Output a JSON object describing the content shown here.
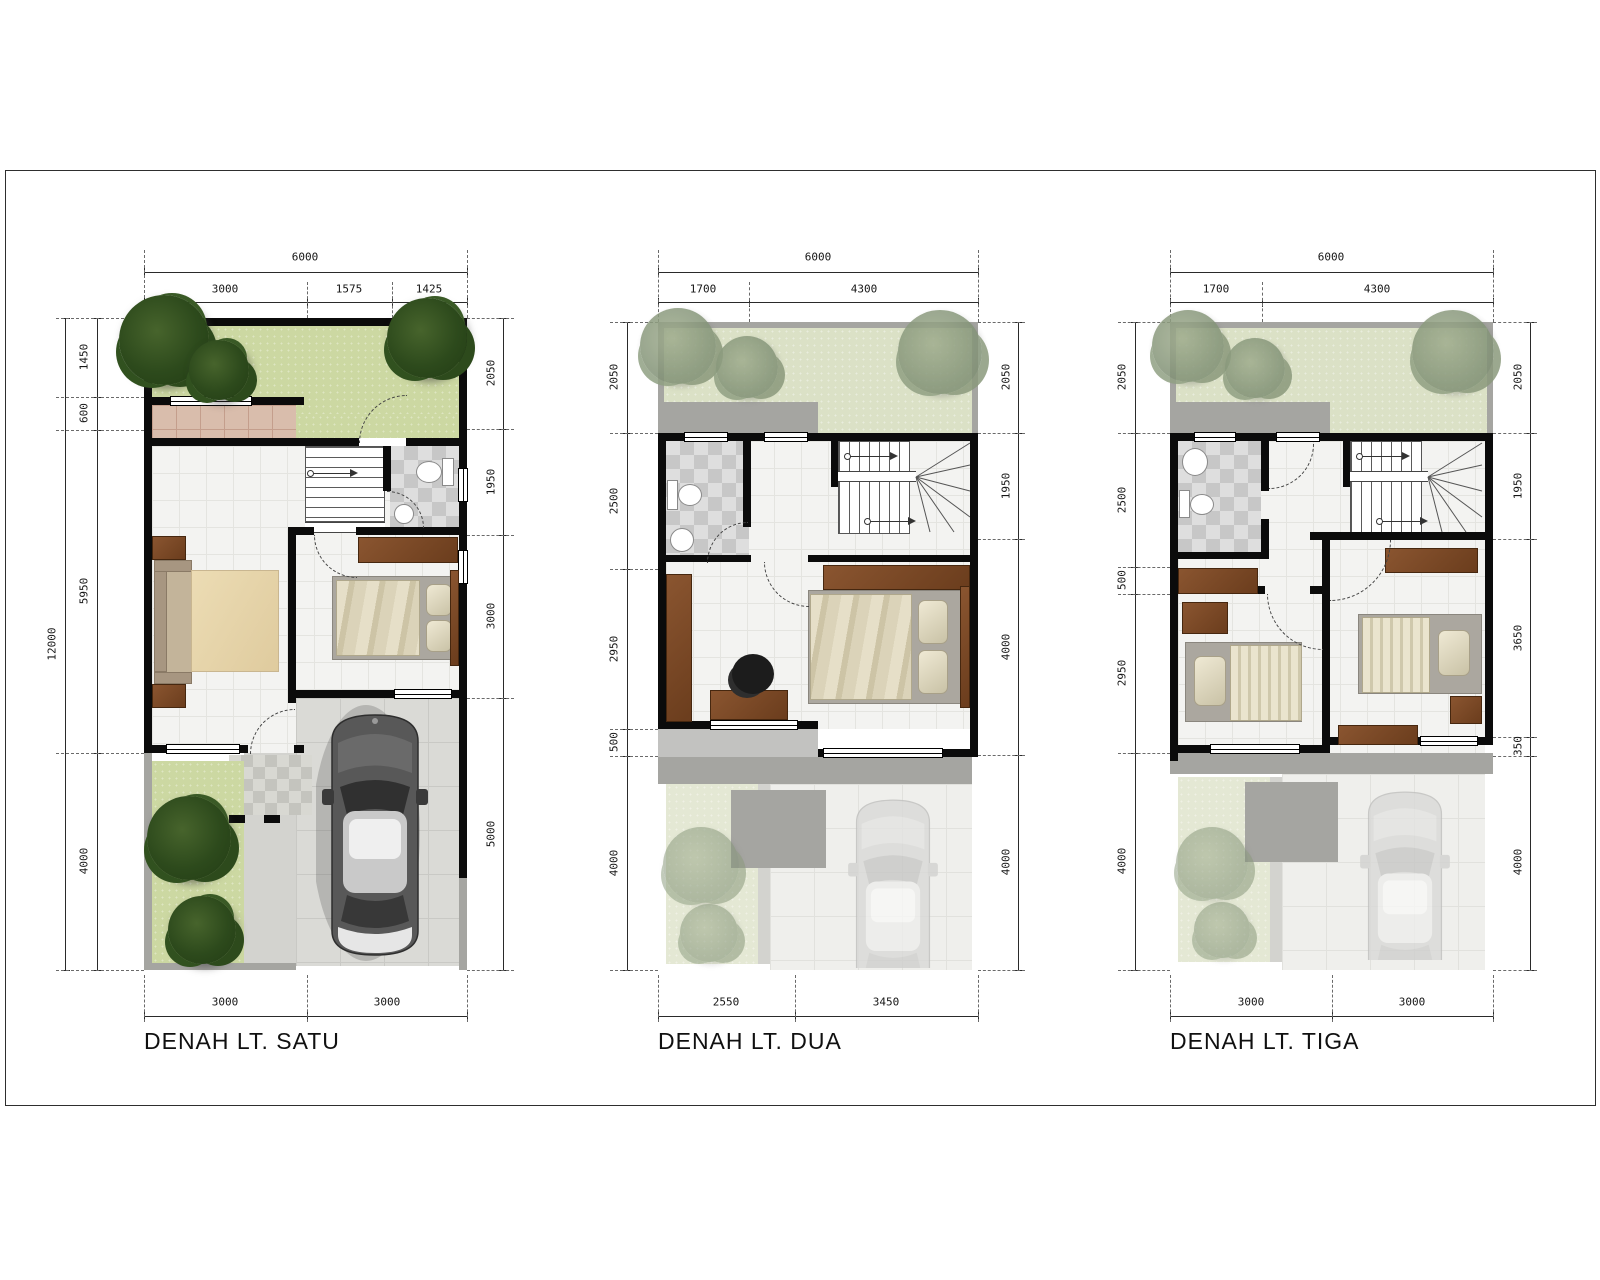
{
  "colors": {
    "wall": "#0b0b0b",
    "grass_ground_floor": "#ccd8a2",
    "grass_roof_garden": "#dbe1c6",
    "tree_dark": "#2d4a1c",
    "tree_faded": "#8a997c",
    "terrace_tile": "#d9bdac",
    "bathroom_tile": "#c7c7c7",
    "floor_tile": "#f3f3f1",
    "carport_floor": "#dadad6",
    "concrete": "#a5a5a1",
    "wood_furniture": "#7c4a26",
    "car_body": "#585858",
    "dimension_text": "#161616"
  },
  "plans": [
    {
      "title": "DENAH LT. SATU",
      "top_total": "6000",
      "top_segments": [
        "3000",
        "1575",
        "1425"
      ],
      "left_total": "12000",
      "left_segments": [
        "1450",
        "600",
        "5950",
        "4000"
      ],
      "right_segments": [
        "2050",
        "1950",
        "3000",
        "5000"
      ],
      "bottom_segments": [
        "3000",
        "3000"
      ]
    },
    {
      "title": "DENAH LT. DUA",
      "top_total": "6000",
      "top_segments": [
        "1700",
        "4300"
      ],
      "left_segments": [
        "2050",
        "2500",
        "2950",
        "500",
        "4000"
      ],
      "right_segments": [
        "2050",
        "1950",
        "4000",
        "4000"
      ],
      "bottom_segments": [
        "2550",
        "3450"
      ]
    },
    {
      "title": "DENAH LT. TIGA",
      "top_total": "6000",
      "top_segments": [
        "1700",
        "4300"
      ],
      "left_segments": [
        "2050",
        "2500",
        "500",
        "2950",
        "4000"
      ],
      "right_segments": [
        "2050",
        "1950",
        "3650",
        "350",
        "4000"
      ],
      "bottom_segments": [
        "3000",
        "3000"
      ]
    }
  ]
}
